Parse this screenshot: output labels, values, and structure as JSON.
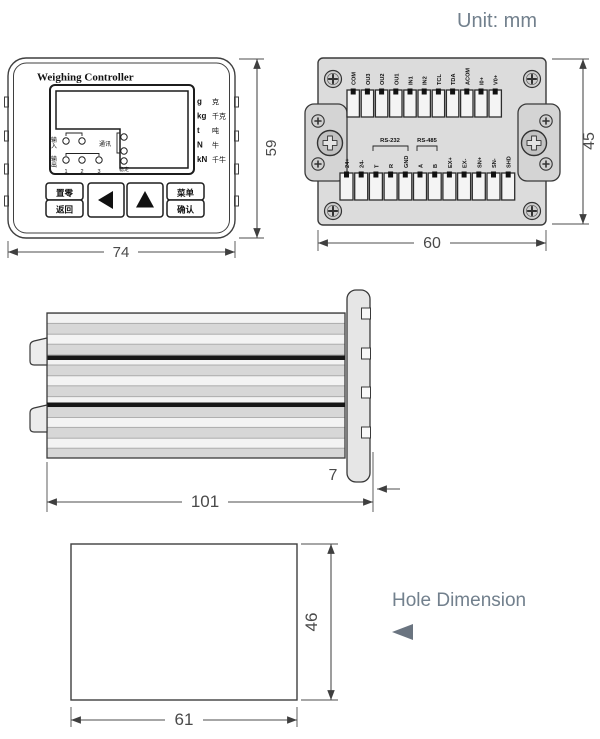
{
  "unit_note": "Unit: mm",
  "front_view": {
    "title": "Weighing Controller",
    "unit_rows": [
      {
        "symbol": "g",
        "cjk": "克"
      },
      {
        "symbol": "kg",
        "cjk": "千克"
      },
      {
        "symbol": "t",
        "cjk": "吨"
      },
      {
        "symbol": "N",
        "cjk": "牛"
      },
      {
        "symbol": "kN",
        "cjk": "千牛"
      }
    ],
    "indicators": {
      "input": "输入",
      "comm": "通讯",
      "output": "输出",
      "stable": "稳定",
      "output_numbers": [
        "1",
        "2",
        "3"
      ]
    },
    "buttons": {
      "zero": "置零",
      "back": "返回",
      "menu": "菜单",
      "confirm": "确认"
    },
    "dims": {
      "width": "74",
      "height": "59"
    }
  },
  "rear_view": {
    "top_terminals": [
      "COM",
      "OU3",
      "OU2",
      "OU1",
      "IN1",
      "IN2",
      "TCL",
      "TDA",
      "ACOM",
      "I0+",
      "V0+"
    ],
    "bottom_terminals": [
      "24+",
      "24-",
      "T",
      "R",
      "GND",
      "A",
      "B",
      "EX+",
      "EX-",
      "SN+",
      "SN-",
      "SHD"
    ],
    "rs232": "RS-232",
    "rs485": "RS-485",
    "dims": {
      "width": "60",
      "height": "45"
    }
  },
  "side_view": {
    "dims": {
      "length": "101",
      "bezel_depth": "7"
    }
  },
  "hole_view": {
    "caption": "Hole Dimension",
    "dims": {
      "width": "61",
      "height": "46"
    }
  },
  "colors": {
    "annotation_text": "#72808d",
    "drawing_line": "#3f3f3f",
    "dim_text": "#4a4a4a",
    "rear_panel_fill": "#dcdcdc"
  }
}
